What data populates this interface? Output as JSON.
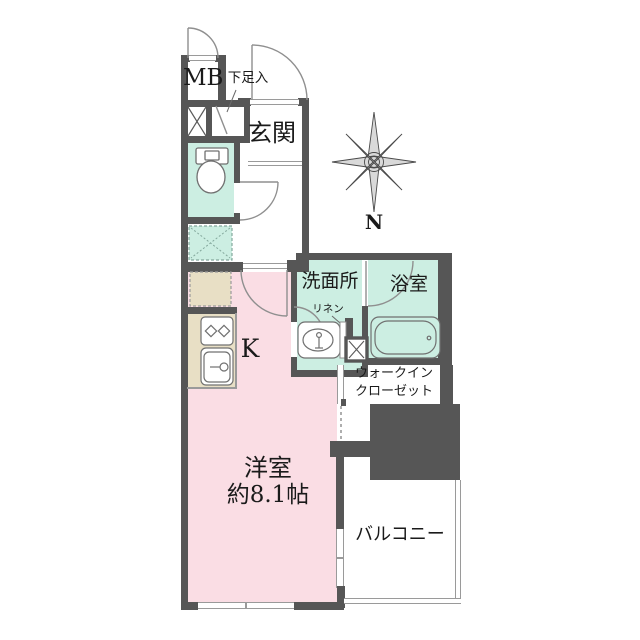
{
  "page_title": "apartment-floor-plan",
  "colors": {
    "wall": "#565656",
    "wet_room_fill": "#cceee2",
    "main_room_fill": "#fadde4",
    "kitchen_counter_fill": "#e8dfc5",
    "thin_line": "#9a9a9a"
  },
  "labels": {
    "meter_box": "MB",
    "shoe_storage": "下足入",
    "entrance": "玄関",
    "washroom": "洗面所",
    "linen": "リネン",
    "bathroom": "浴室",
    "kitchen": "K",
    "walk_in_closet_line1": "ウォークイン",
    "walk_in_closet_line2": "クローゼット",
    "main_room_name": "洋室",
    "main_room_size": "約8.1帖",
    "balcony": "バルコニー",
    "compass_north": "N"
  }
}
